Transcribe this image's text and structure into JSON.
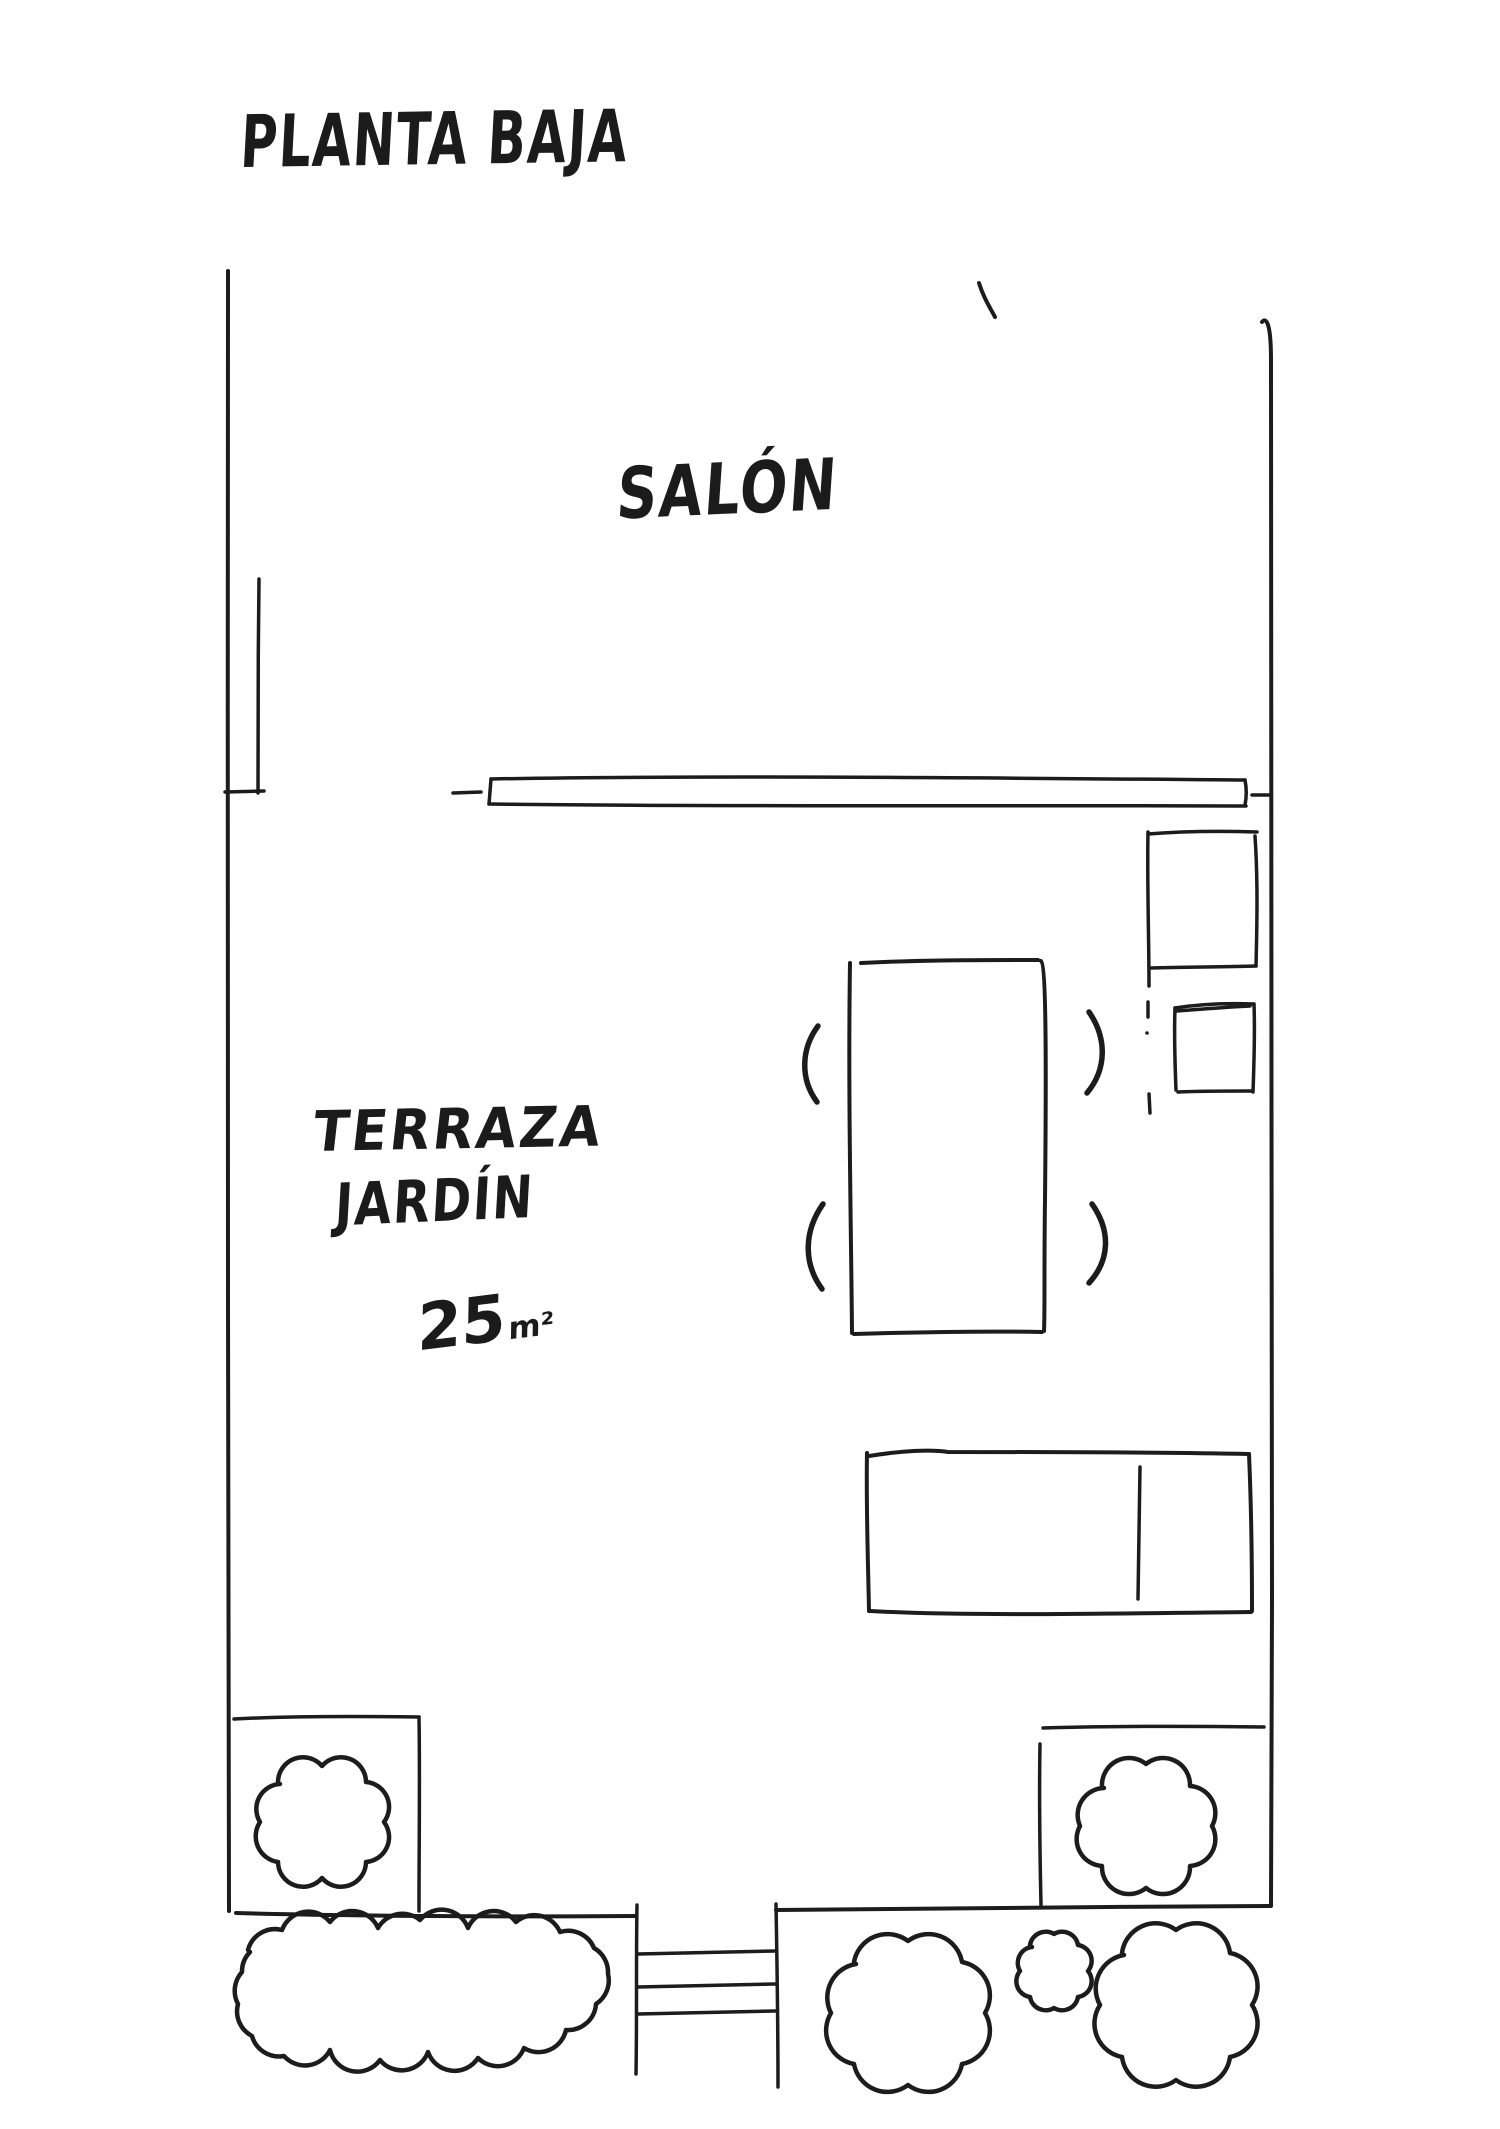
{
  "document": {
    "kind": "hand-drawn floor plan sketch",
    "ink_color": "#1c1c1c",
    "paper_color": "#ffffff"
  },
  "labels": {
    "title": "PLANTA BAJA",
    "salon": "SALÓN",
    "terraza_line1": "TERRAZA",
    "terraza_line2": "JARDÍN",
    "area_value": "25",
    "area_unit": "m²"
  },
  "plan_elements": [
    {
      "name": "left-wall"
    },
    {
      "name": "right-wall"
    },
    {
      "name": "bottom-wall"
    },
    {
      "name": "interior-wall-stub"
    },
    {
      "name": "top-pen-stroke"
    },
    {
      "name": "sliding-glass-door"
    },
    {
      "name": "dining-table"
    },
    {
      "name": "chair",
      "count": 4
    },
    {
      "name": "storage-box-large"
    },
    {
      "name": "storage-box-small"
    },
    {
      "name": "dashed-marks"
    },
    {
      "name": "garden-bench"
    },
    {
      "name": "planter-box-left"
    },
    {
      "name": "planter-box-right"
    },
    {
      "name": "garden-steps",
      "step_count": 3
    },
    {
      "name": "bush",
      "count": 6
    }
  ]
}
